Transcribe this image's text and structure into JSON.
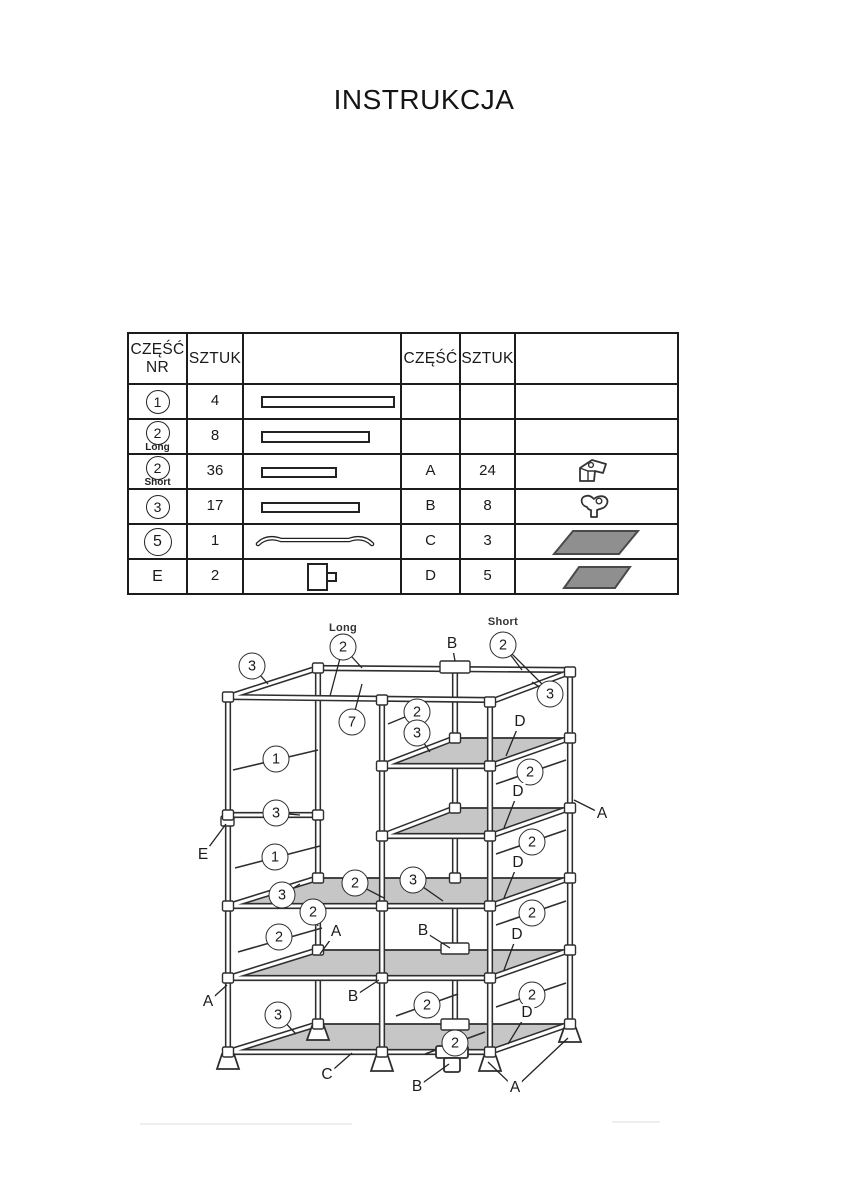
{
  "title": "INSTRUKCJA",
  "parts_table": {
    "headers": {
      "czesc": "CZĘŚĆ",
      "nr": "NR",
      "sztuk": "SZTUK"
    },
    "left_rows": [
      {
        "part": "1",
        "qty": "4",
        "icon": "bar-long"
      },
      {
        "part": "2",
        "sub": "Long",
        "qty": "8",
        "icon": "bar-medium"
      },
      {
        "part": "2",
        "sub": "Short",
        "qty": "36",
        "icon": "bar-short"
      },
      {
        "part": "3",
        "qty": "17",
        "icon": "bar-medium-2"
      },
      {
        "part": "5",
        "qty": "1",
        "icon": "curved-hanging-rod"
      },
      {
        "part": "E",
        "qty": "2",
        "icon": "clip-bracket"
      }
    ],
    "right_rows": [
      {
        "part": "",
        "qty": "",
        "icon": ""
      },
      {
        "part": "",
        "qty": "",
        "icon": ""
      },
      {
        "part": "A",
        "qty": "24",
        "icon": "corner-connector-3way"
      },
      {
        "part": "B",
        "qty": "8",
        "icon": "connector-4way"
      },
      {
        "part": "C",
        "qty": "3",
        "icon": "shelf-panel-large"
      },
      {
        "part": "D",
        "qty": "5",
        "icon": "shelf-panel-small"
      }
    ]
  },
  "diagram": {
    "labels": {
      "long": "Long",
      "short": "Short"
    },
    "shelf_color": "#c6c6c6",
    "panel_color": "#8f8f8f",
    "line_color": "#2e2e2e",
    "callouts": [
      {
        "x": 343,
        "y": 647,
        "label": "2",
        "shape": "circle"
      },
      {
        "x": 503,
        "y": 645,
        "label": "2",
        "shape": "circle"
      },
      {
        "x": 252,
        "y": 666,
        "label": "3",
        "shape": "circle"
      },
      {
        "x": 550,
        "y": 694,
        "label": "3",
        "shape": "circle"
      },
      {
        "x": 352,
        "y": 722,
        "label": "7",
        "shape": "circle"
      },
      {
        "x": 417,
        "y": 712,
        "label": "2",
        "shape": "circle"
      },
      {
        "x": 417,
        "y": 733,
        "label": "3",
        "shape": "circle"
      },
      {
        "x": 276,
        "y": 759,
        "label": "1",
        "shape": "circle"
      },
      {
        "x": 530,
        "y": 772,
        "label": "2",
        "shape": "circle"
      },
      {
        "x": 276,
        "y": 813,
        "label": "3",
        "shape": "circle"
      },
      {
        "x": 275,
        "y": 857,
        "label": "1",
        "shape": "circle"
      },
      {
        "x": 532,
        "y": 842,
        "label": "2",
        "shape": "circle"
      },
      {
        "x": 355,
        "y": 883,
        "label": "2",
        "shape": "circle"
      },
      {
        "x": 413,
        "y": 880,
        "label": "3",
        "shape": "circle"
      },
      {
        "x": 282,
        "y": 895,
        "label": "3",
        "shape": "circle"
      },
      {
        "x": 313,
        "y": 912,
        "label": "2",
        "shape": "circle"
      },
      {
        "x": 279,
        "y": 937,
        "label": "2",
        "shape": "circle"
      },
      {
        "x": 532,
        "y": 913,
        "label": "2",
        "shape": "circle"
      },
      {
        "x": 427,
        "y": 1005,
        "label": "2",
        "shape": "circle"
      },
      {
        "x": 532,
        "y": 995,
        "label": "2",
        "shape": "circle"
      },
      {
        "x": 455,
        "y": 1043,
        "label": "2",
        "shape": "circle"
      },
      {
        "x": 278,
        "y": 1015,
        "label": "3",
        "shape": "circle"
      },
      {
        "x": 452,
        "y": 644,
        "label": "B",
        "shape": "plain"
      },
      {
        "x": 520,
        "y": 722,
        "label": "D",
        "shape": "plain"
      },
      {
        "x": 518,
        "y": 792,
        "label": "D",
        "shape": "plain"
      },
      {
        "x": 602,
        "y": 814,
        "label": "A",
        "shape": "plain"
      },
      {
        "x": 203,
        "y": 855,
        "label": "E",
        "shape": "plain"
      },
      {
        "x": 518,
        "y": 863,
        "label": "D",
        "shape": "plain"
      },
      {
        "x": 336,
        "y": 932,
        "label": "A",
        "shape": "plain"
      },
      {
        "x": 423,
        "y": 931,
        "label": "B",
        "shape": "plain"
      },
      {
        "x": 517,
        "y": 935,
        "label": "D",
        "shape": "plain"
      },
      {
        "x": 208,
        "y": 1002,
        "label": "A",
        "shape": "plain"
      },
      {
        "x": 353,
        "y": 997,
        "label": "B",
        "shape": "plain"
      },
      {
        "x": 527,
        "y": 1013,
        "label": "D",
        "shape": "plain"
      },
      {
        "x": 327,
        "y": 1075,
        "label": "C",
        "shape": "plain"
      },
      {
        "x": 417,
        "y": 1087,
        "label": "B",
        "shape": "plain"
      },
      {
        "x": 515,
        "y": 1088,
        "label": "A",
        "shape": "plain"
      }
    ]
  }
}
